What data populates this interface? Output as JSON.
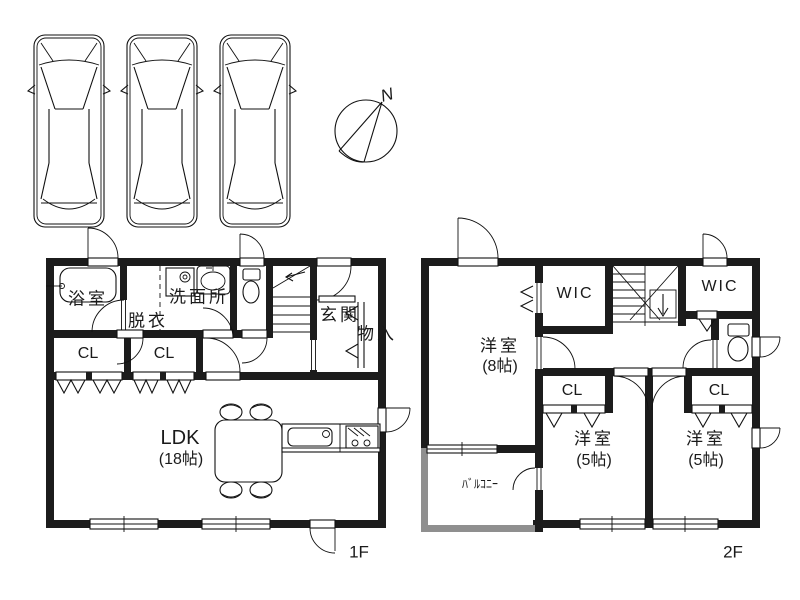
{
  "meta": {
    "wall_color": "#1c1c1c",
    "balcony_wall_color": "#8f8f8f",
    "bg_color": "#ffffff",
    "line_color": "#111111"
  },
  "parking": {
    "spaces": 3
  },
  "compass": {
    "north_label": "N"
  },
  "floor1": {
    "floor_label": "1F",
    "bathroom": "浴室",
    "dressing": "脱衣",
    "washroom": "洗面所",
    "entrance": "玄関",
    "storage": "物入",
    "closet_left": "CL",
    "closet_right": "CL",
    "ldk": {
      "name": "LDK",
      "size": "(18帖)"
    }
  },
  "floor2": {
    "floor_label": "2F",
    "wic_left": "WIC",
    "wic_right": "WIC",
    "bedroom_large": {
      "name": "洋室",
      "size": "(8帖)"
    },
    "closet_left": "CL",
    "closet_right": "CL",
    "bedroom_left": {
      "name": "洋室",
      "size": "(5帖)"
    },
    "bedroom_right": {
      "name": "洋室",
      "size": "(5帖)"
    },
    "balcony": "ﾊﾞﾙｺﾆｰ"
  }
}
